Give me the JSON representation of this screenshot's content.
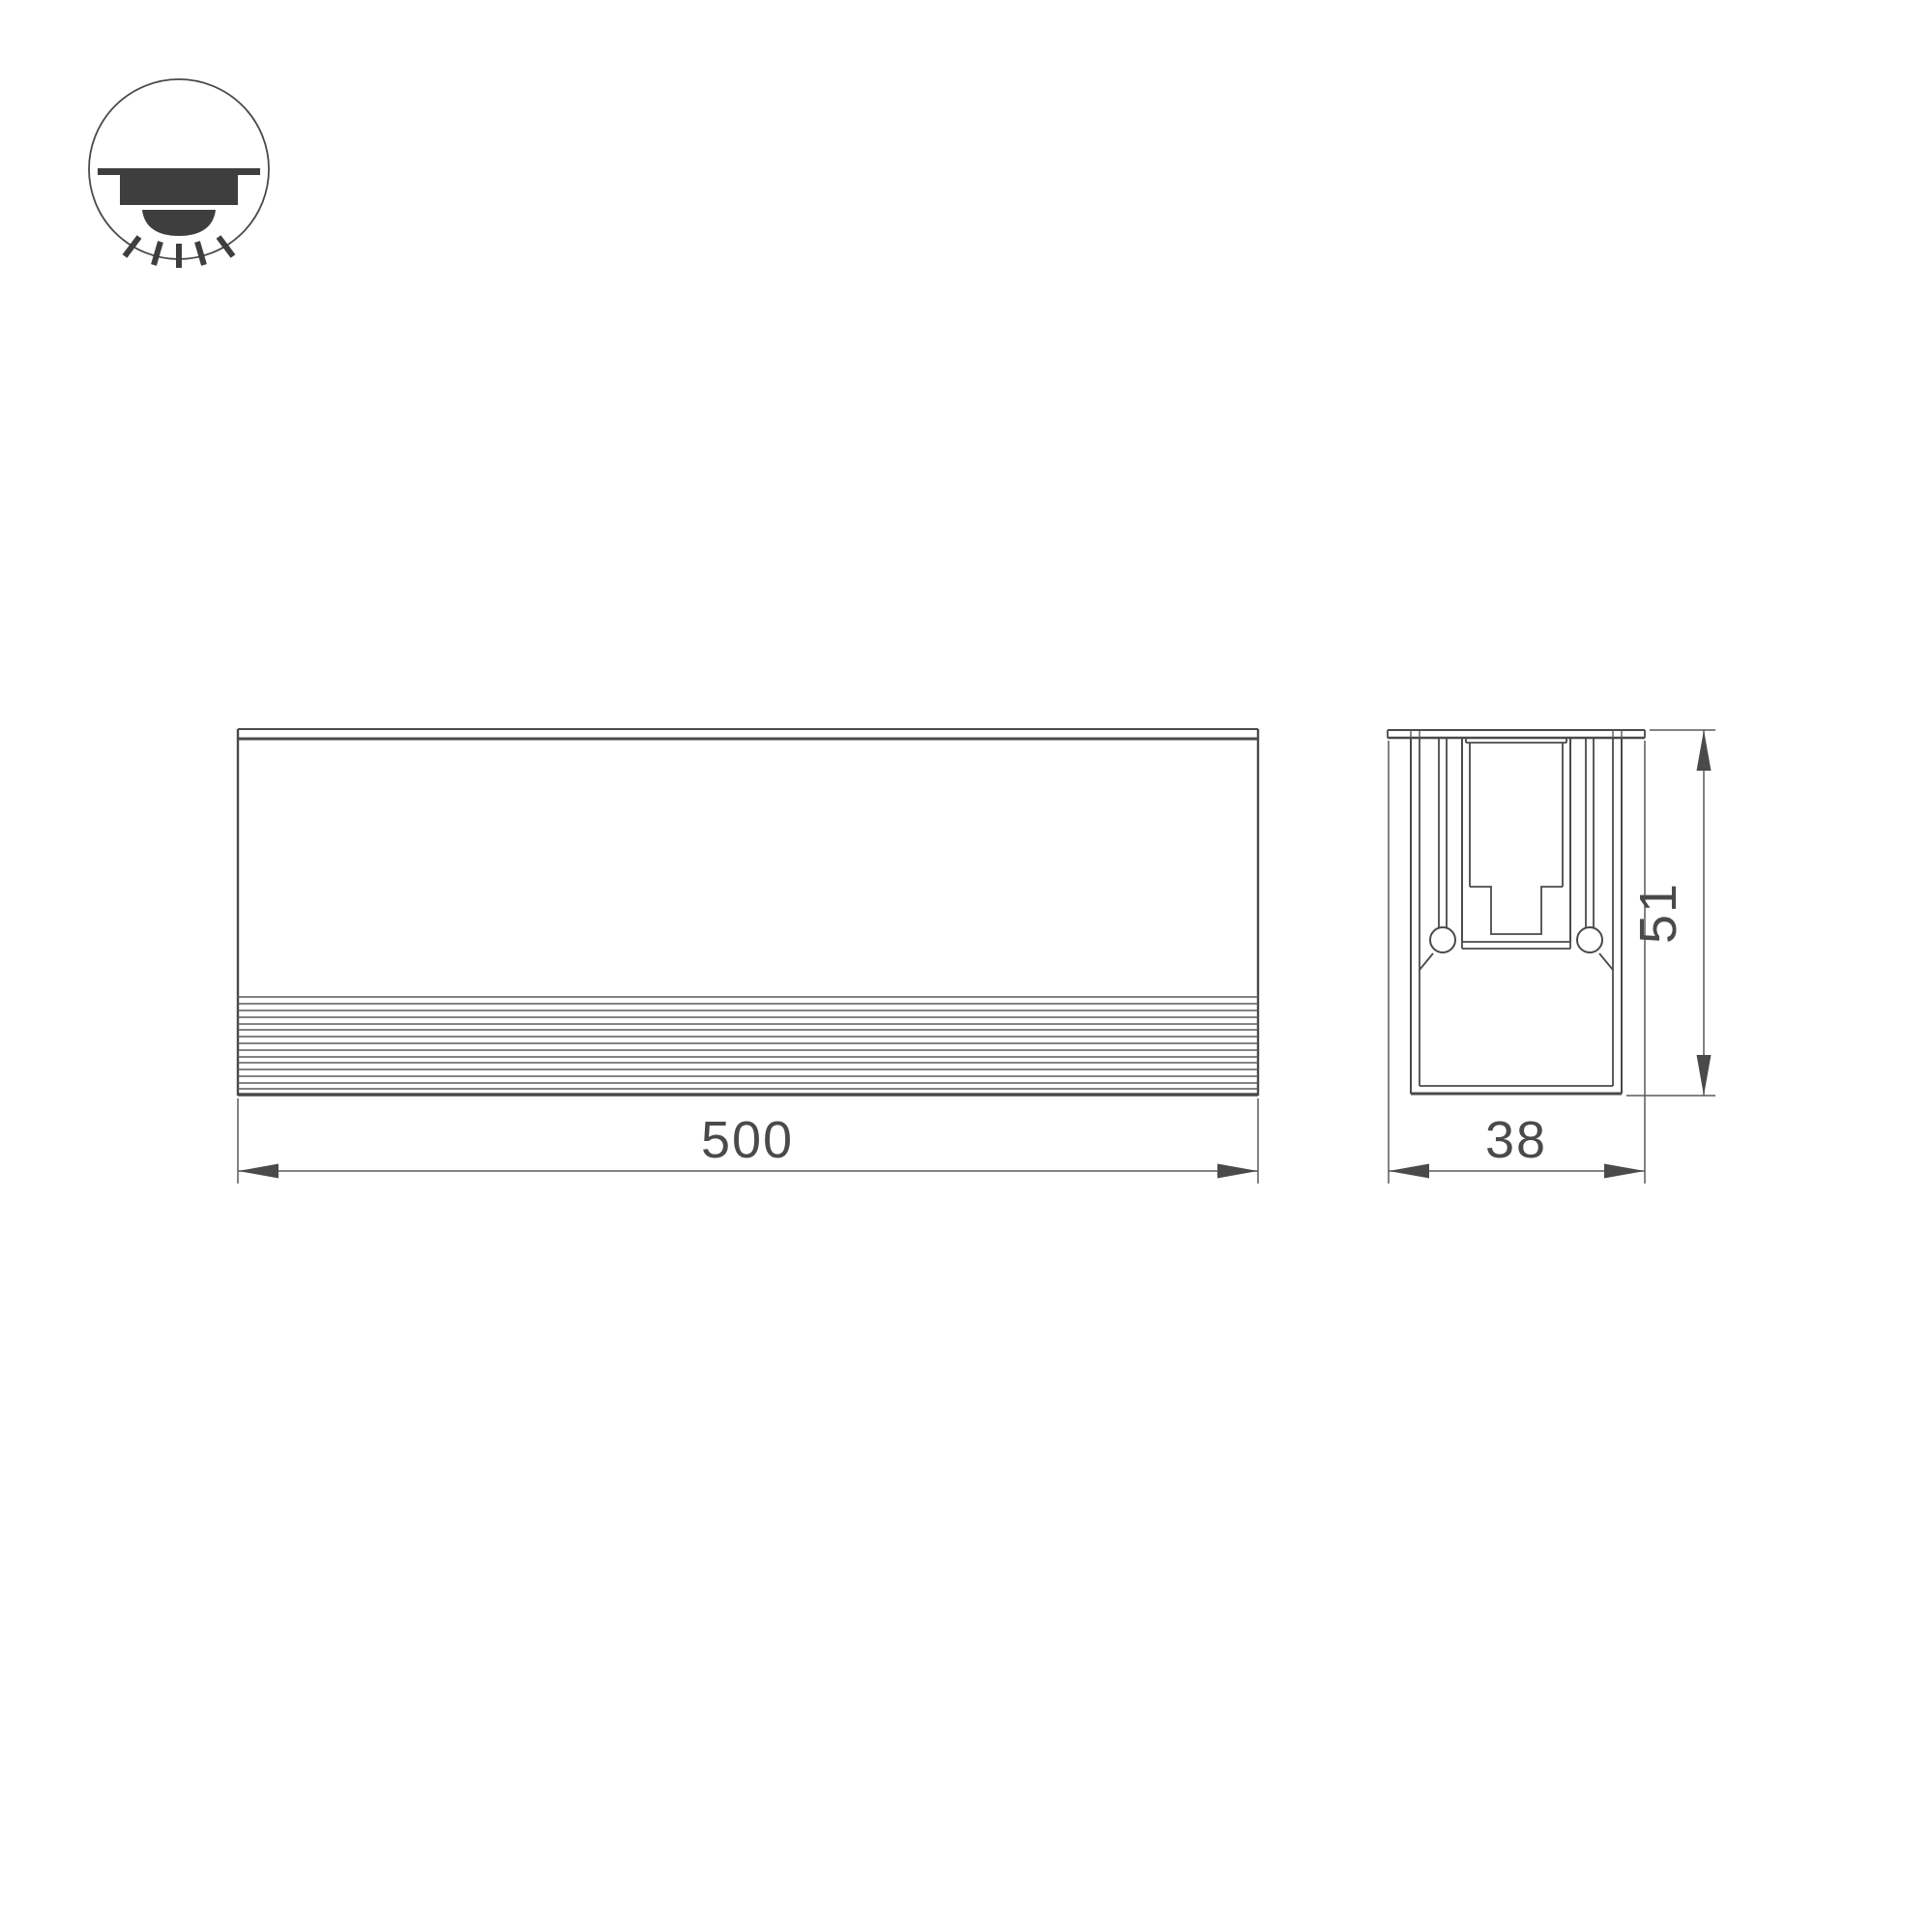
{
  "drawing": {
    "dimensions": {
      "length": "500",
      "width": "38",
      "height": "51"
    },
    "icon": {
      "type": "recessed-downlight"
    },
    "colors": {
      "line": "#4a4a4a",
      "line-light": "#5a5a5a",
      "icon-fill": "#3e3e3e",
      "background": "#ffffff"
    }
  }
}
